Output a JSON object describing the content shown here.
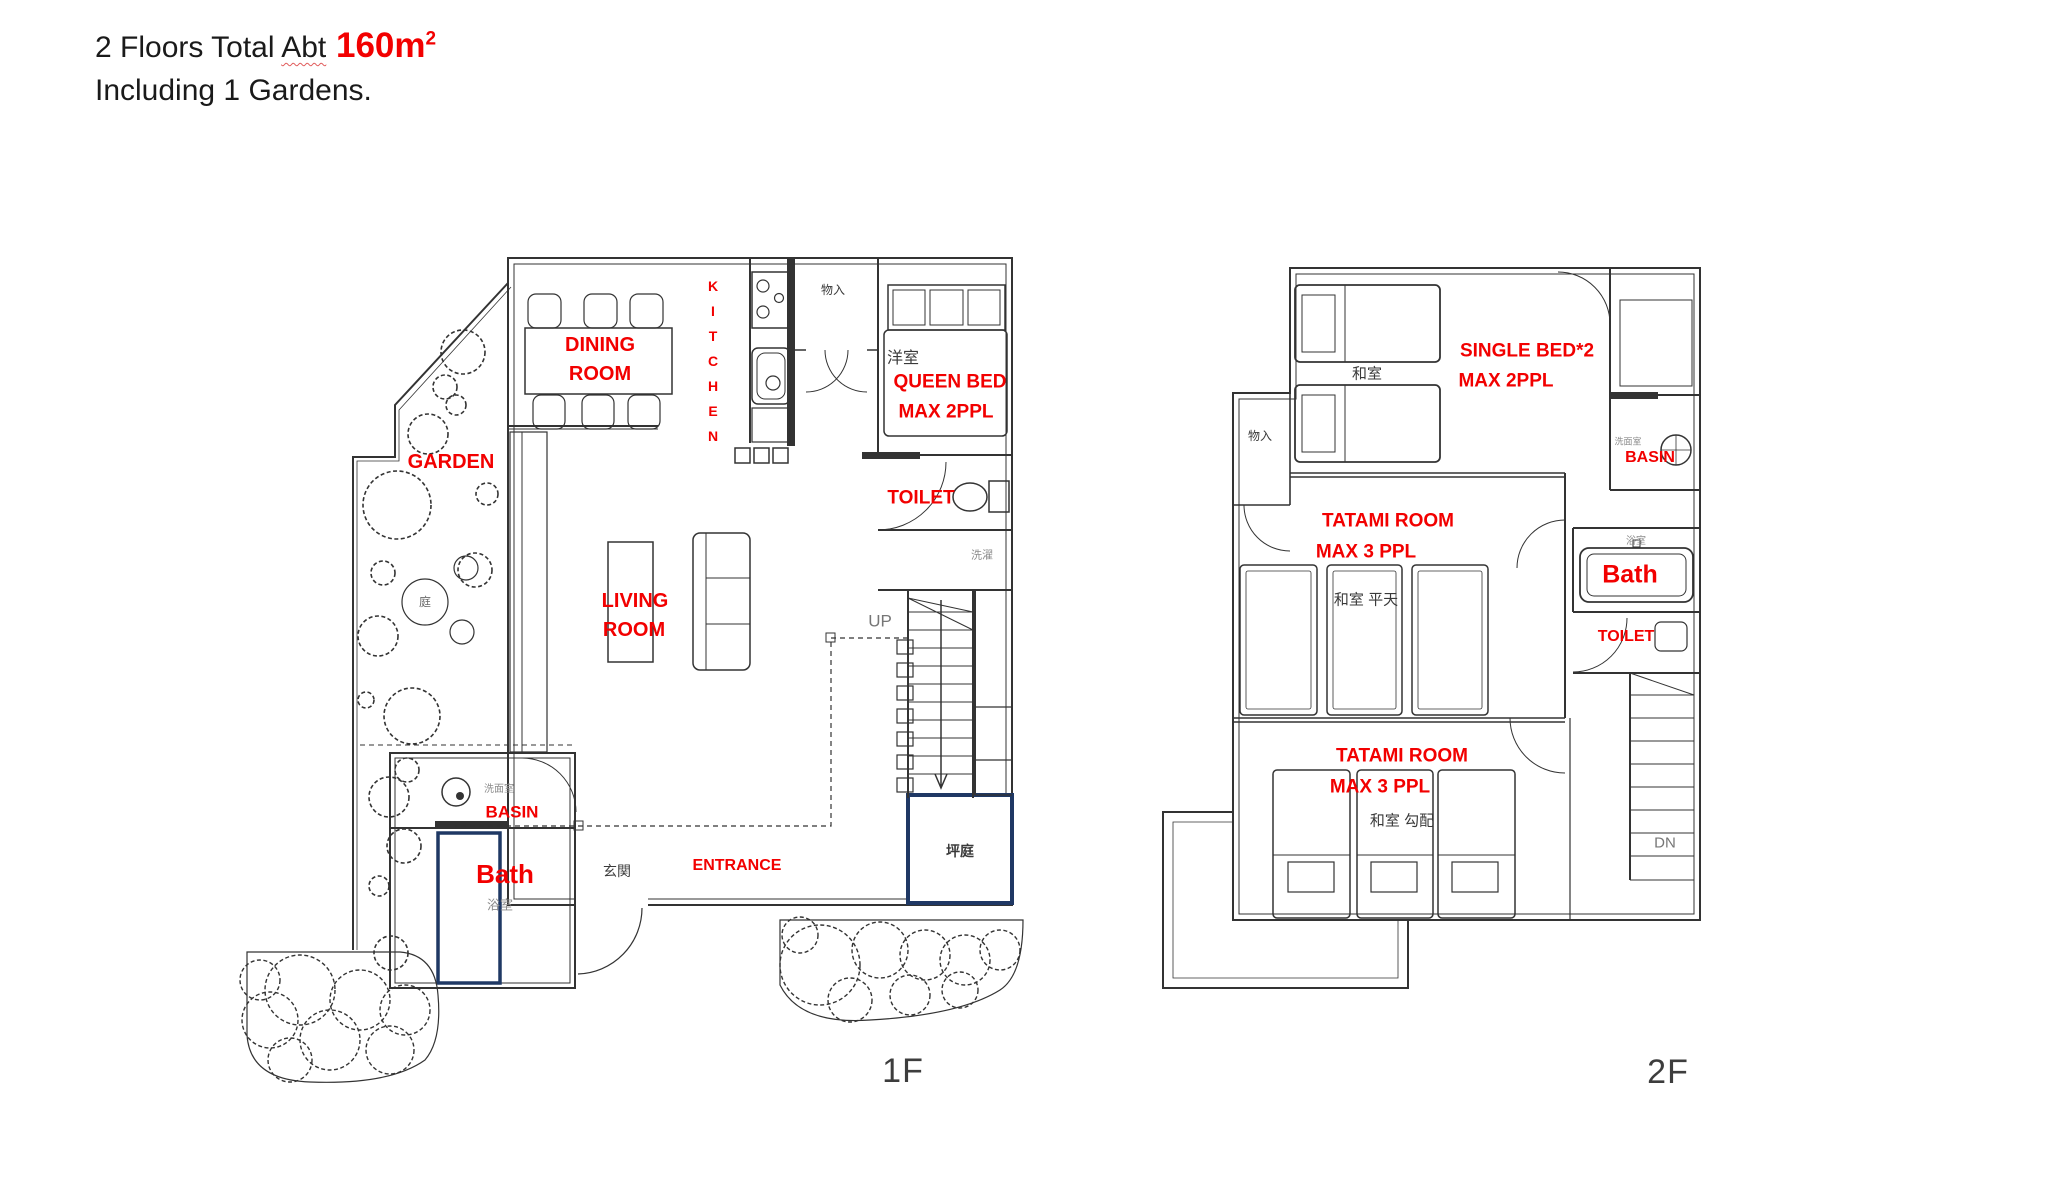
{
  "colors": {
    "accent_red": "#f20000",
    "box_navy": "#1f3864",
    "line_ink": "#333333",
    "grey_text": "#8c8c8c"
  },
  "header": {
    "title_prefix": "2 Floors Total ",
    "title_abt": "Abt",
    "title_area": " 160m",
    "title_area_sup": "2",
    "subtitle": "Including 1 Gardens."
  },
  "floor1": {
    "floor_label": "1F",
    "labels": {
      "dining1": "DINING",
      "dining2": "ROOM",
      "kitchen": "KITCHEN",
      "western_room": "洋室",
      "queen1": "QUEEN BED",
      "queen2": "MAX 2PPL",
      "closet": "物入",
      "garden": "GARDEN",
      "toilet": "TOILET",
      "laundry": "洗濯",
      "up": "UP",
      "living1": "LIVING",
      "living2": "ROOM",
      "washroom": "洗面室",
      "basin": "BASIN",
      "bath": "Bath",
      "bathroom_jp": "浴室",
      "genkan": "玄関",
      "entrance": "ENTRANCE",
      "courtyard": "坪庭",
      "garden_stone": "庭"
    }
  },
  "floor2": {
    "floor_label": "2F",
    "labels": {
      "single1": "SINGLE BED*2",
      "single2": "MAX 2PPL",
      "washitsu_top": "和室",
      "closet": "物入",
      "tatami_mid1": "TATAMI ROOM",
      "tatami_mid2": "MAX 3 PPL",
      "washitsu_mid": "和室  平天",
      "washroom": "洗面室",
      "basin": "BASIN",
      "bathroom_jp": "浴室",
      "bath": "Bath",
      "toilet": "TOILET",
      "tatami_low1": "TATAMI ROOM",
      "tatami_low2": "MAX 3 PPL",
      "washitsu_low": "和室  勾配",
      "dn": "DN"
    }
  }
}
